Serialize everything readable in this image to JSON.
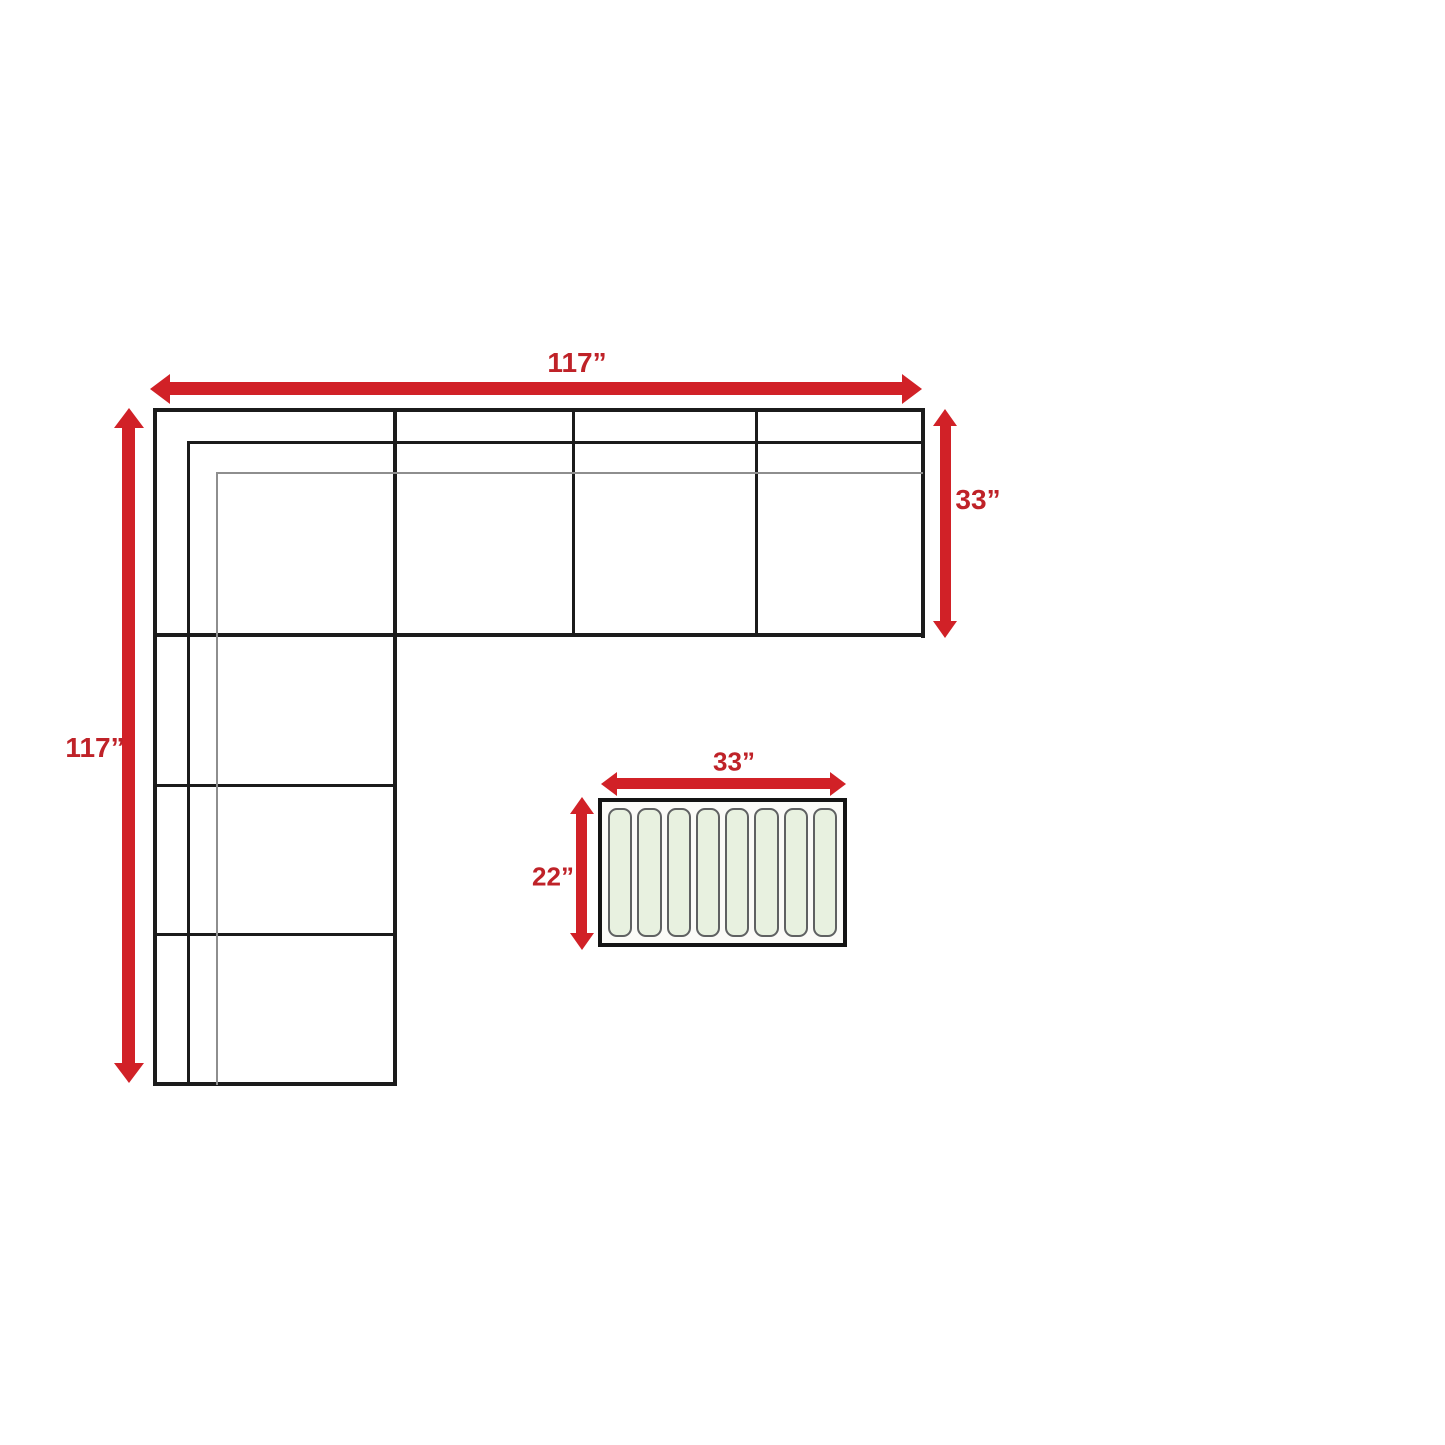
{
  "colors": {
    "arrow_red": "#d12127",
    "label_red": "#bf2228",
    "line_dark": "#1b1b1b",
    "line_thin": "#8e8e8e",
    "table_border": "#141414",
    "slat_fill": "#e8f1e0",
    "slat_border": "#5f6162"
  },
  "sofa": {
    "width_label": "117”",
    "height_label": "117”",
    "depth_label": "33”"
  },
  "coffee_table": {
    "width_label": "33”",
    "depth_label": "22”",
    "slat_count": 8
  }
}
